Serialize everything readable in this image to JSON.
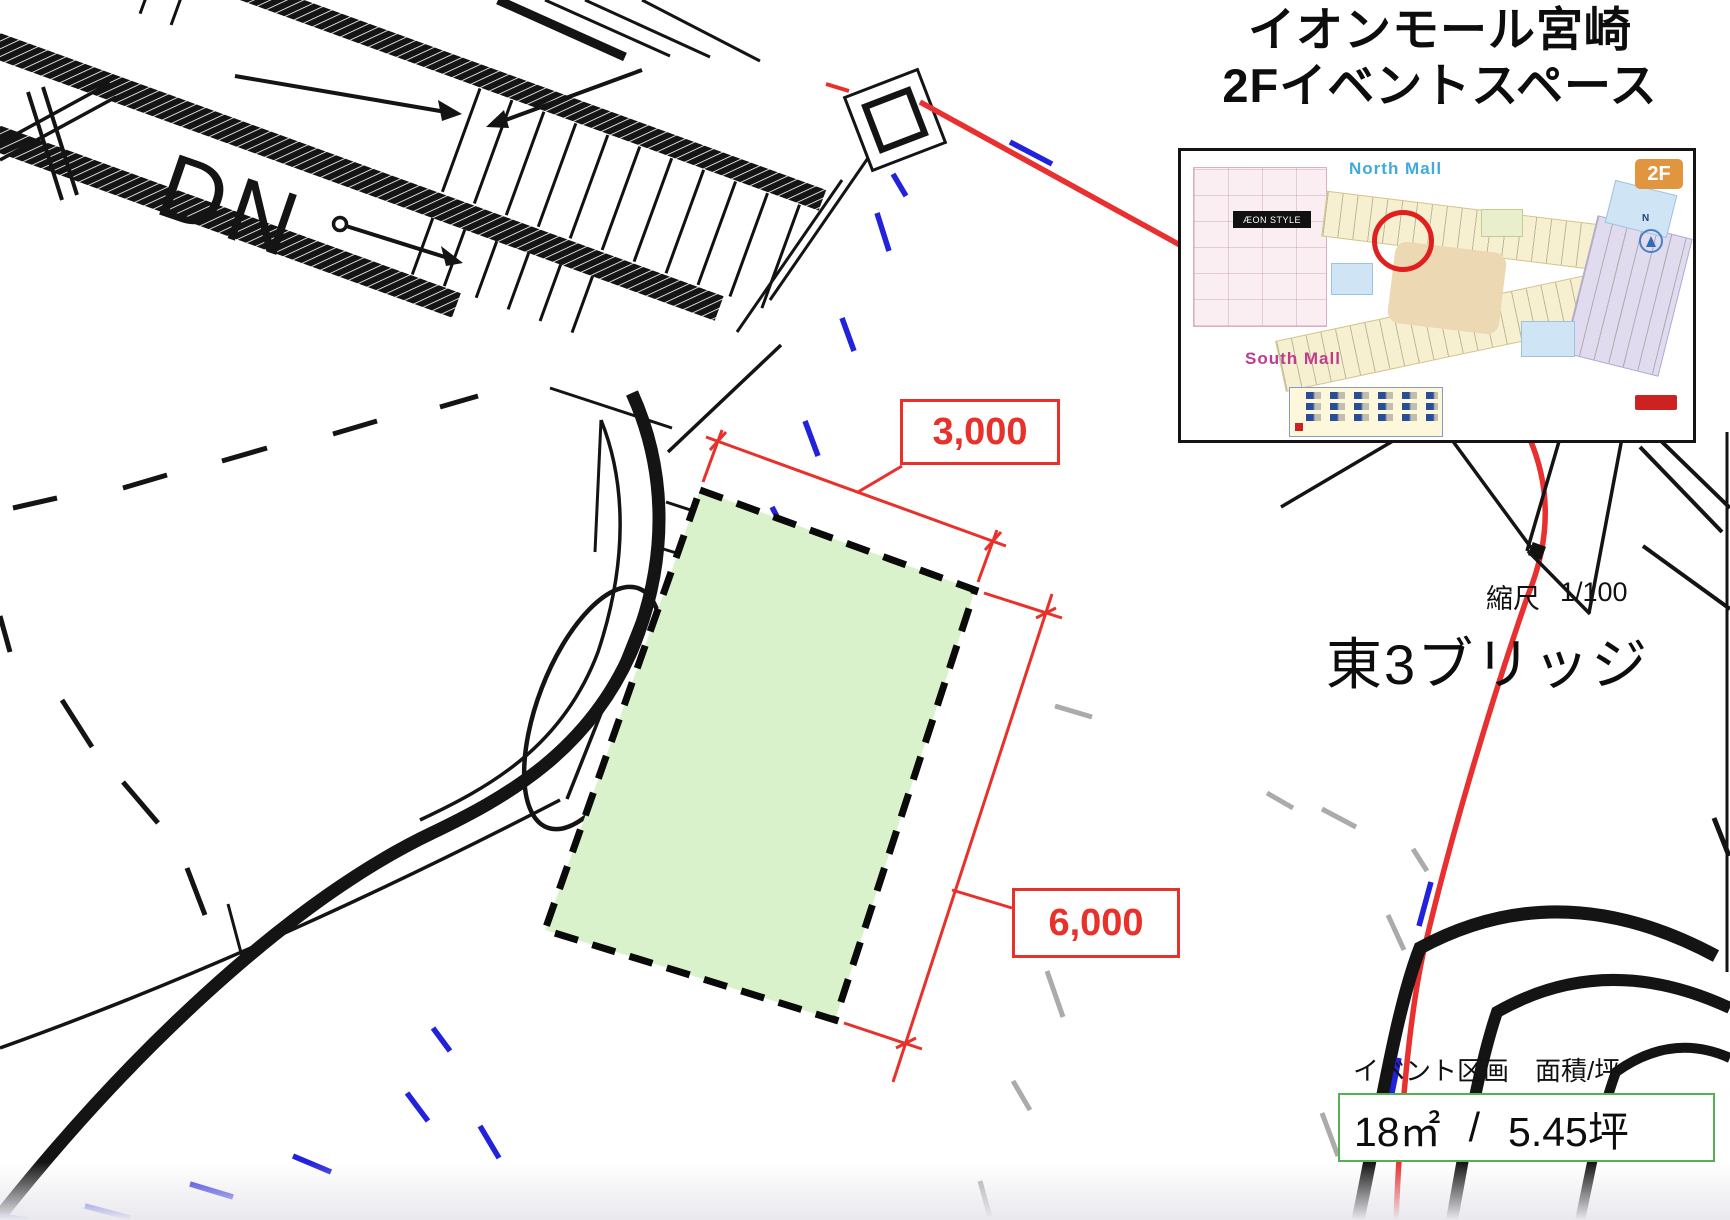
{
  "header": {
    "title_line1": "イオンモール宮崎",
    "title_line2": "2Fイベントスペース"
  },
  "map_inset": {
    "north_mall_label": "North Mall",
    "south_mall_label": "South Mall",
    "floor_badge": "2F",
    "aeon_style_label": "ÆON STYLE",
    "compass_label": "N"
  },
  "scale": {
    "label": "縮尺",
    "value": "1/100"
  },
  "location_title": "東3ブリッジ",
  "event_area": {
    "caption": "イベント区画　面積/坪",
    "sqm": "18㎡",
    "separator": "/",
    "tsubo": "5.45坪"
  },
  "dimensions": {
    "top": "3,000",
    "side": "6,000"
  },
  "plan": {
    "stairs_label": "DN"
  },
  "colors": {
    "accent_red": "#e8312a",
    "event_fill": "#d9f2cc",
    "event_box_border": "#55b055",
    "blue_dash": "#2222dd",
    "gray_dash": "#ababab"
  }
}
